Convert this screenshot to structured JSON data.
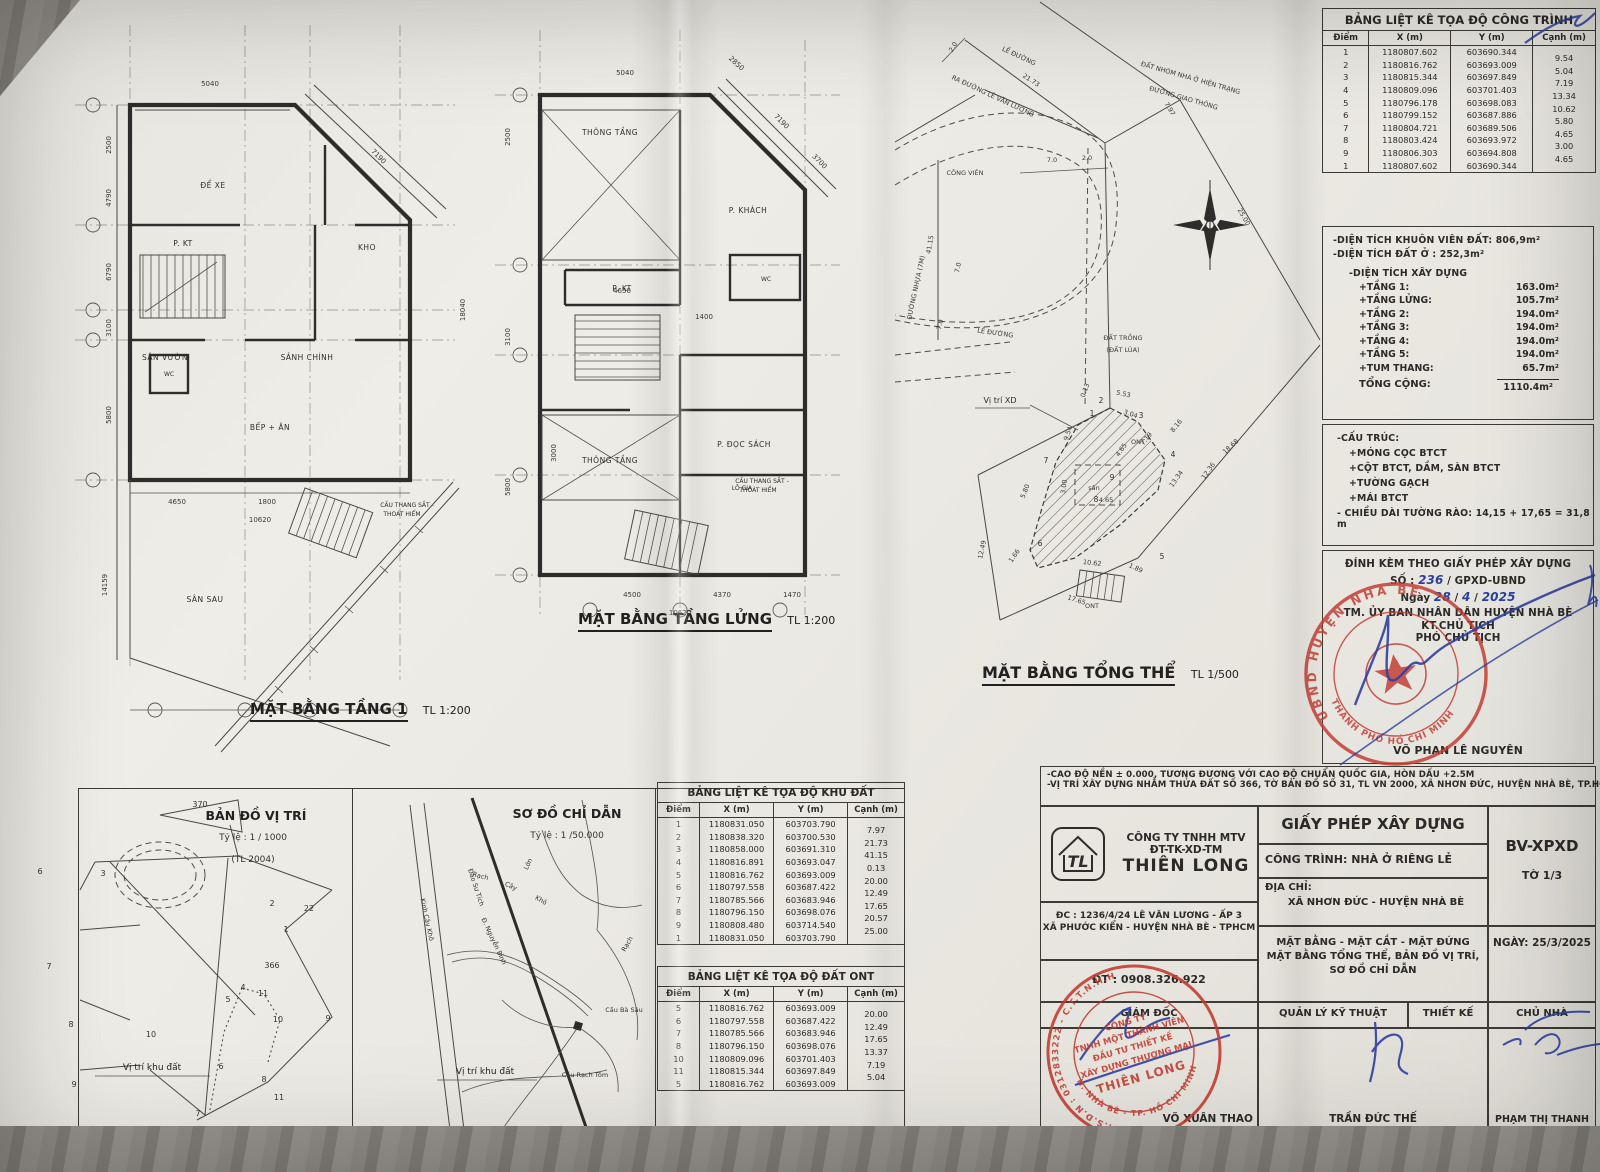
{
  "plans": {
    "floor1": {
      "title": "MẶT BẰNG TẦNG 1",
      "scale": "TL 1:200",
      "rooms": {
        "dexe": "ĐỂ XE",
        "kho": "KHO",
        "pkt": "P. KT",
        "sanvuon": "SÂN VƯỜN",
        "sanhchinh": "SẢNH CHÍNH",
        "bepan": "BẾP + ĂN",
        "wc": "WC",
        "sansau": "SÂN SAU"
      },
      "stair_note": [
        "CẦU THANG SẮT -",
        "THOÁT HIỂM"
      ],
      "dims": [
        "5040",
        "7190",
        "4650",
        "1800",
        "10620",
        "14159",
        "2500",
        "4790",
        "6790",
        "3100",
        "5800",
        "18040"
      ]
    },
    "mezz": {
      "title": "MẶT BẰNG TẦNG LỬNG",
      "scale": "TL 1:200",
      "rooms": {
        "thongtang": "THÔNG TẦNG",
        "pkhach": "P. KHÁCH",
        "pkt": "P. KT",
        "wc": "WC",
        "thongtang2": "THÔNG TẦNG",
        "pdocsach": "P. ĐỌC SÁCH",
        "logia": "LÔ GIA"
      },
      "stair_note": [
        "CẦU THANG SẮT -",
        "THOÁT HIỂM"
      ],
      "dims": [
        "5040",
        "2850",
        "7190",
        "3700",
        "4650",
        "1400",
        "3000",
        "2500",
        "3100",
        "5800",
        "4500",
        "4370",
        "1470",
        "10620"
      ]
    },
    "site": {
      "title": "MẶT BẰNG TỔNG THỂ",
      "scale": "TL 1/500",
      "labels": {
        "leduong": "LỀ ĐƯỜNG",
        "leduong2": "LỀ ĐƯỜNG",
        "raduong": "RA ĐƯỜNG LÊ VĂN LƯƠNG",
        "congvien": "CÔNG VIÊN",
        "duongnhua": "ĐƯỜNG NHỰA (7M)",
        "datnhom": "ĐẤT NHÓM NHÀ Ở HIỆN TRẠNG",
        "duonggt": "ĐƯỜNG GIAO THÔNG",
        "datlua1": "ĐẤT TRỒNG",
        "datlua2": "(ĐẤT LÚA)",
        "vitrixd": "Vị trí XD",
        "san": "sân",
        "ont": "ONT"
      },
      "dims": [
        "2.0",
        "7.0",
        "2.0",
        "7.0",
        "7.0",
        "21.73",
        "7.97",
        "25.00",
        "41.15",
        "18.68",
        "1.89",
        "17.65",
        "12.49",
        "5.53",
        "3.04",
        "0.13",
        "9.54",
        "4.65",
        "3.00",
        "4.65",
        "5.80",
        "1.66",
        "10.62",
        "13.34",
        "12.36",
        "7.19",
        "8.16"
      ],
      "points": [
        "2",
        "3",
        "4",
        "9",
        "8",
        "7",
        "6",
        "5",
        "1"
      ]
    }
  },
  "tables": {
    "congtrinh": {
      "title": "BẢNG LIỆT KÊ TỌA ĐỘ CÔNG TRÌNH",
      "headers": [
        "Điểm",
        "X (m)",
        "Y (m)",
        "Cạnh (m)"
      ],
      "rows": [
        [
          "1",
          "1180807.602",
          "603690.344"
        ],
        [
          "2",
          "1180816.762",
          "603693.009"
        ],
        [
          "3",
          "1180815.344",
          "603697.849"
        ],
        [
          "4",
          "1180809.096",
          "603701.403"
        ],
        [
          "5",
          "1180796.178",
          "603698.083"
        ],
        [
          "6",
          "1180799.152",
          "603687.886"
        ],
        [
          "7",
          "1180804.721",
          "603689.506"
        ],
        [
          "8",
          "1180803.424",
          "603693.972"
        ],
        [
          "9",
          "1180806.303",
          "603694.808"
        ],
        [
          "1",
          "1180807.602",
          "603690.344"
        ]
      ],
      "canh": [
        "9.54",
        "5.04",
        "7.19",
        "13.34",
        "10.62",
        "5.80",
        "4.65",
        "3.00",
        "4.65"
      ]
    },
    "khudat": {
      "title": "BẢNG LIỆT KÊ TỌA ĐỘ KHU ĐẤT",
      "headers": [
        "Điểm",
        "X (m)",
        "Y (m)",
        "Cạnh (m)"
      ],
      "rows": [
        [
          "1",
          "1180831.050",
          "603703.790"
        ],
        [
          "2",
          "1180838.320",
          "603700.530"
        ],
        [
          "3",
          "1180858.000",
          "603691.310"
        ],
        [
          "4",
          "1180816.891",
          "603693.047"
        ],
        [
          "5",
          "1180816.762",
          "603693.009"
        ],
        [
          "6",
          "1180797.558",
          "603687.422"
        ],
        [
          "7",
          "1180785.566",
          "603683.946"
        ],
        [
          "8",
          "1180796.150",
          "603698.076"
        ],
        [
          "9",
          "1180808.480",
          "603714.540"
        ],
        [
          "1",
          "1180831.050",
          "603703.790"
        ]
      ],
      "canh": [
        "7.97",
        "21.73",
        "41.15",
        "0.13",
        "20.00",
        "12.49",
        "17.65",
        "20.57",
        "25.00"
      ]
    },
    "ont": {
      "title": "BẢNG LIỆT KÊ TỌA ĐỘ ĐẤT ONT",
      "headers": [
        "Điểm",
        "X (m)",
        "Y (m)",
        "Cạnh (m)"
      ],
      "rows": [
        [
          "5",
          "1180816.762",
          "603693.009"
        ],
        [
          "6",
          "1180797.558",
          "603687.422"
        ],
        [
          "7",
          "1180785.566",
          "603683.946"
        ],
        [
          "8",
          "1180796.150",
          "603698.076"
        ],
        [
          "10",
          "1180809.096",
          "603701.403"
        ],
        [
          "11",
          "1180815.344",
          "603697.849"
        ],
        [
          "5",
          "1180816.762",
          "603693.009"
        ]
      ],
      "canh": [
        "20.00",
        "12.49",
        "17.65",
        "13.37",
        "7.19",
        "5.04"
      ]
    }
  },
  "areas": {
    "l1": "-DIỆN TÍCH KHUÔN VIÊN ĐẤT: 806,9m²",
    "l2": "-DIỆN TÍCH ĐẤT Ở : 252,3m²",
    "header": "-DIỆN TÍCH XÂY DỰNG",
    "items": [
      {
        "label": "+TẦNG 1:",
        "value": "163.0m²"
      },
      {
        "label": "+TẦNG LỬNG:",
        "value": "105.7m²"
      },
      {
        "label": "+TẦNG 2:",
        "value": "194.0m²"
      },
      {
        "label": "+TẦNG 3:",
        "value": "194.0m²"
      },
      {
        "label": "+TẦNG 4:",
        "value": "194.0m²"
      },
      {
        "label": "+TẦNG 5:",
        "value": "194.0m²"
      },
      {
        "label": "+TUM THANG:",
        "value": "65.7m²"
      }
    ],
    "total_label": "TỔNG CỘNG:",
    "total_value": "1110.4m²"
  },
  "structure": {
    "lines": [
      "-CẤU TRÚC:",
      "+MÓNG CỌC BTCT",
      "+CỘT BTCT, DẦM, SÀN BTCT",
      "+TƯỜNG GẠCH",
      "+MÁI BTCT",
      "- CHIỀU DÀI TƯỜNG RÀO: 14,15 + 17,65 = 31,8 m"
    ]
  },
  "permit": {
    "l1": "ĐÍNH KÈM THEO GIẤY PHÉP XÂY DỰNG",
    "so_label": "SỐ :",
    "so_value": "236",
    "so_suffix": "/ GPXD-UBND",
    "ngay_label": "Ngày",
    "d": "28",
    "m": "4",
    "y": "2025",
    "l4": "TM. ỦY BAN NHÂN DÂN HUYỆN NHÀ BÈ",
    "l5": "KT.CHỦ TỊCH",
    "l6": "PHÓ CHỦ TỊCH"
  },
  "notes": {
    "n1": "-CAO ĐỘ NỀN ± 0.000, TƯƠNG ĐƯƠNG VỚI CAO ĐỘ CHUẨN QUỐC GIA, HÒN DẤU +2.5M",
    "n2": "-VỊ TRÍ XÂY DỰNG NHẰM THỬA ĐẤT SỐ 366, TỜ BẢN ĐỒ SỐ 31, TL VN 2000, XÃ NHƠN ĐỨC, HUYỆN NHÀ BÈ, TP.HCM"
  },
  "titleblock": {
    "company": {
      "l1": "CÔNG TY TNHH MTV",
      "l2": "ĐT-TK-XD-TM",
      "name": "THIÊN LONG",
      "logo": "TL",
      "addr1": "ĐC : 1236/4/24 LÊ VĂN LƯƠNG - ẤP 3",
      "addr2": "XÃ PHƯỚC KIỂN - HUYỆN NHÀ BÈ - TPHCM",
      "phone": "ĐT : 0908.326.922"
    },
    "permit_title": "GIẤY PHÉP XÂY DỰNG",
    "project": "CÔNG TRÌNH: NHÀ Ở RIÊNG LẺ",
    "addr_label": "ĐỊA CHỈ:",
    "addr_value": "XÃ NHƠN ĐỨC - HUYỆN NHÀ BÈ",
    "sheet_code": "BV-XPXD",
    "sheet_no": "TỜ 1/3",
    "content1": "MẶT BẰNG - MẶT CẮT - MẶT ĐỨNG",
    "content2": "MẶT BẰNG TỔNG THỂ, BẢN ĐỒ VỊ TRÍ,",
    "content3": "SƠ ĐỒ CHỈ DẪN",
    "date": "NGÀY:  25/3/2025",
    "roles": {
      "giamdoc": "GIÁM ĐỐC",
      "qlkt": "QUẢN LÝ KỸ THUẬT",
      "thietke": "THIẾT KẾ",
      "chunha": "CHỦ NHÀ"
    },
    "names": {
      "giamdoc": "VÕ XUÂN THAO",
      "qlkt": "TRẦN ĐỨC THẾ",
      "chunha": "PHẠM THỊ THANH"
    }
  },
  "maps": {
    "vitri": {
      "title": "BẢN ĐỒ VỊ TRÍ",
      "scale": "Tỷ lệ : 1 / 1000",
      "note": "(TL 2004)",
      "label": "Vị trí khu đất",
      "parcels": [
        "370",
        "6",
        "3",
        "2",
        "22",
        "7",
        "366",
        "1",
        "4",
        "5",
        "11",
        "10",
        "9",
        "8",
        "10",
        "6",
        "9",
        "8",
        "11",
        "7"
      ]
    },
    "chidan": {
      "title": "SƠ ĐỒ CHỈ DẪN",
      "scale": "Tỷ lệ : 1 /50.000",
      "label": "Vị trí khu đất",
      "names": {
        "kinh": "Kinh Cây Khô",
        "dao": "Đào Sư Tích",
        "nguyen": "Đ. Nguyễn Bình",
        "rach": "Rạch",
        "cay": "Cây",
        "kho": "Khô",
        "lon": "Lớn",
        "rach2": "Rạch",
        "caubasau": "Cầu Bà Sáu",
        "caurachtom": "Cầu Rạch Tôm"
      }
    }
  },
  "stamps": {
    "official": {
      "arc_top": "UBND HUYỆN NHÀ BÈ",
      "arc_bottom": "THÀNH PHỐ HỒ CHÍ MINH",
      "name": "VÕ PHAN LÊ NGUYÊN"
    },
    "company": {
      "ring_top": "M.S.D.N : 0312833222 - C.T.T.N.H.H",
      "ring_bottom": "H. NHÀ BÈ - TP. HỒ CHÍ MINH",
      "lines": [
        "CÔNG TY",
        "TNHH MỘT THÀNH VIÊN",
        "ĐẦU TƯ THIẾT KẾ",
        "XÂY DỰNG THƯƠNG MẠI",
        "THIÊN LONG"
      ]
    }
  }
}
